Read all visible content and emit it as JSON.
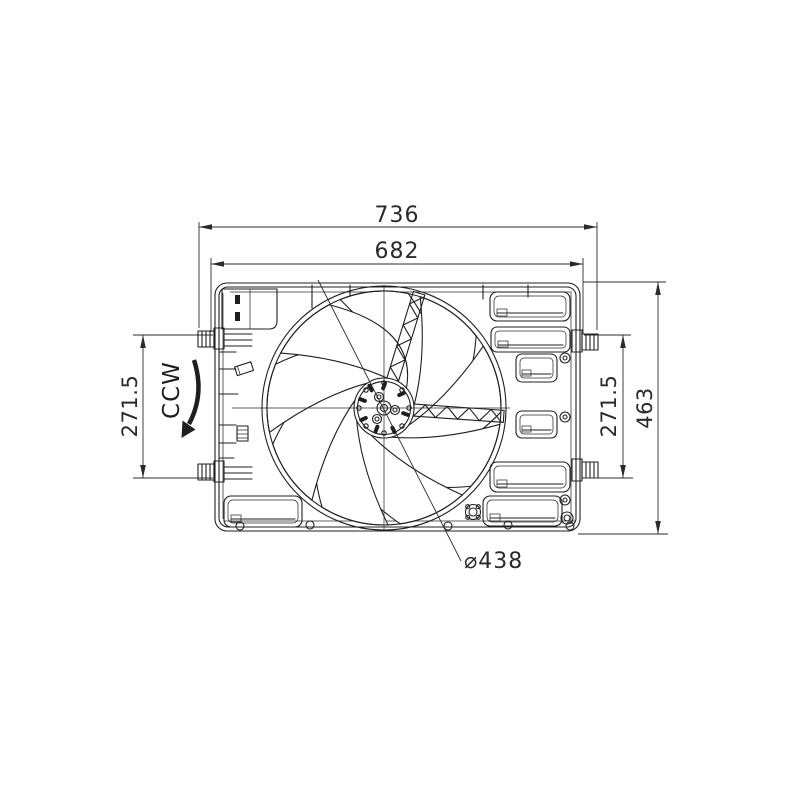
{
  "drawing": {
    "labels": {
      "width_outer": "736",
      "width_inner": "682",
      "height_left": "271.5",
      "height_right": "271.5",
      "height_overall": "463",
      "fan_diameter": "⌀438",
      "rotation": "CCW"
    },
    "colors": {
      "line": "#1f1f1f",
      "dimension": "#2a2a2a",
      "background": "#ffffff"
    }
  }
}
